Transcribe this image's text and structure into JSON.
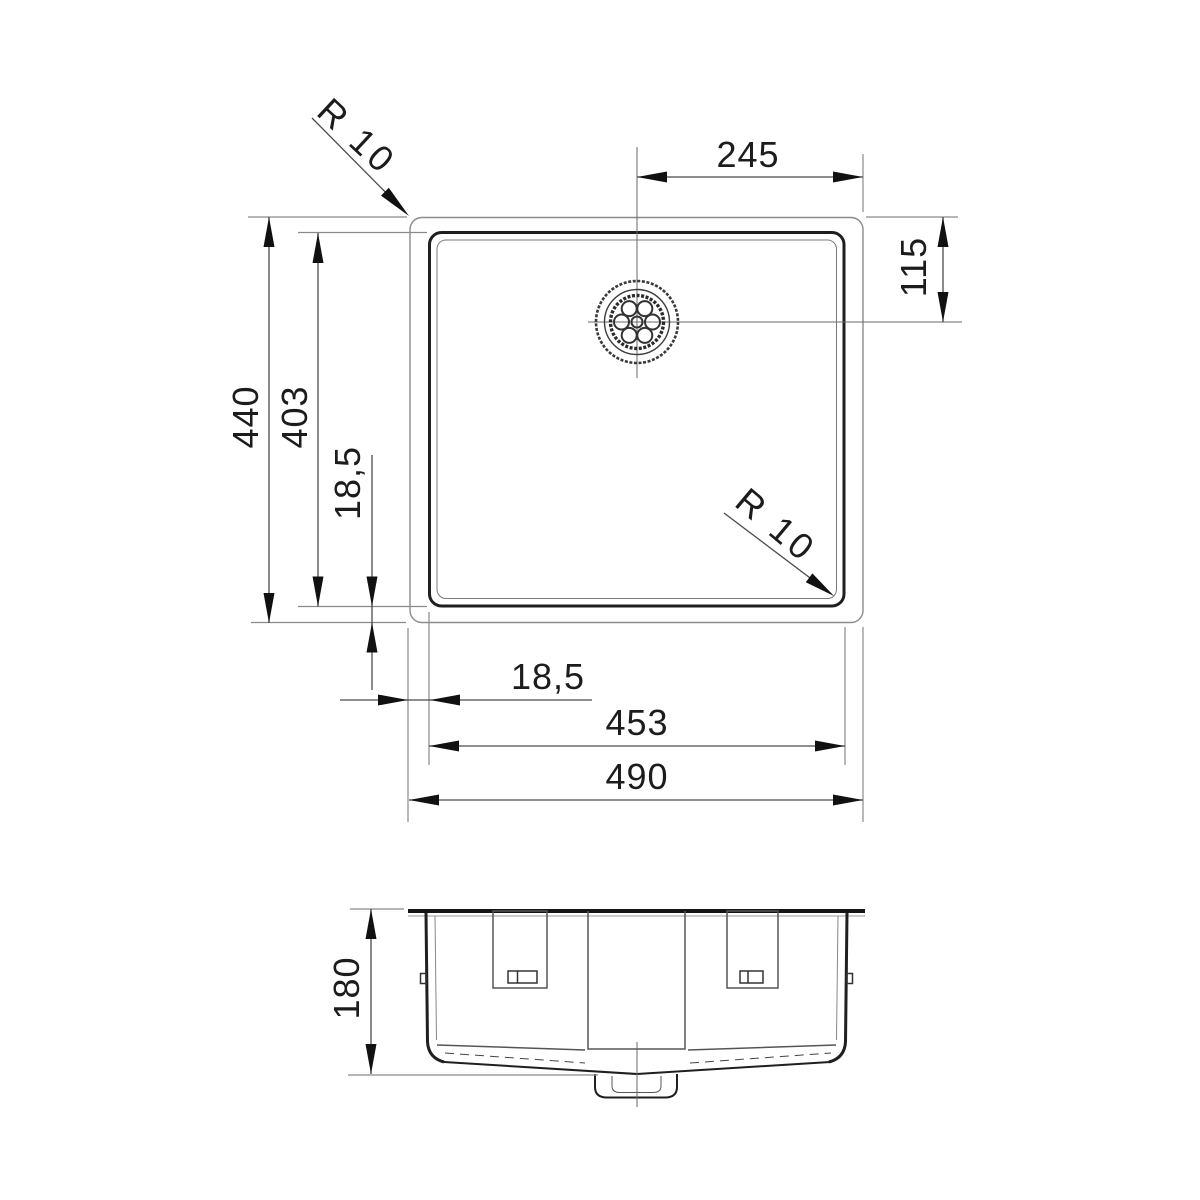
{
  "drawing": {
    "kind": "technical-dimension-drawing",
    "subject": "undermount-kitchen-sink",
    "units": "mm",
    "views": {
      "top_view": "plan view of bowl with drain",
      "front_view": "elevation with mounting brackets and drain stub"
    }
  },
  "dims": {
    "outer_width": "490",
    "inner_width": "453",
    "outer_height": "440",
    "inner_height": "403",
    "rim_inset_left": "18,5",
    "rim_inset_bottom": "18,5",
    "drain_from_right": "245",
    "drain_from_top": "115",
    "depth": "180",
    "radius_outer": "R 10",
    "radius_inner": "R 10"
  },
  "colors": {
    "line_dark": "#1f1f1f",
    "line_gray": "#8c8c8c",
    "text": "#1c1c1c",
    "background": "#ffffff"
  }
}
